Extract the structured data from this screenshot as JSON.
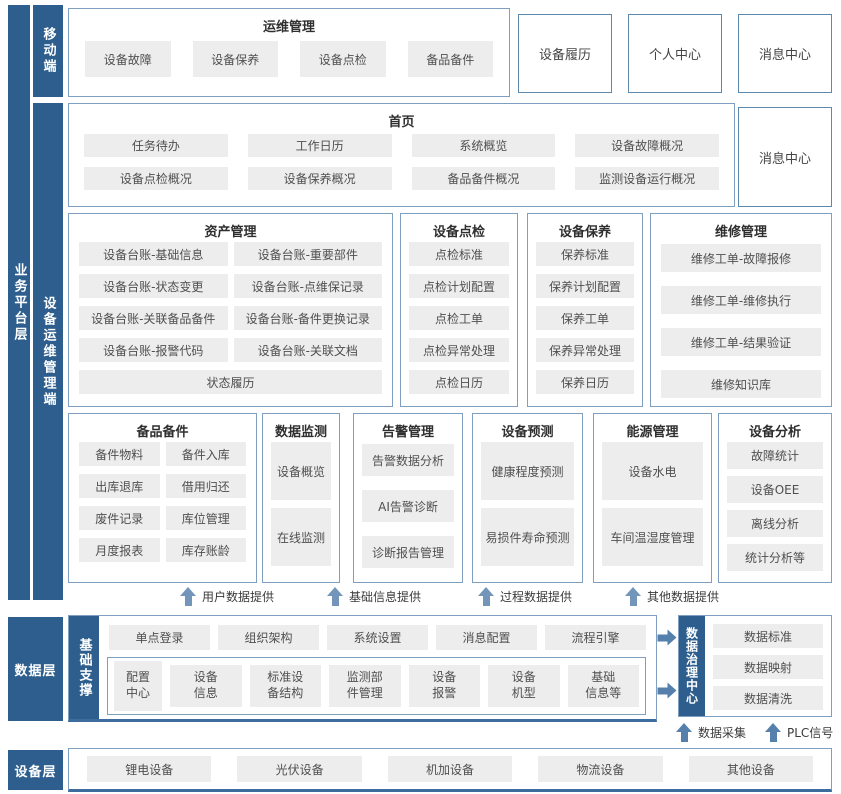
{
  "colors": {
    "dark_blue": "#2d5e8e",
    "box_border": "#7e9fbf",
    "button_bg": "#ededed",
    "arrow": "#7495ba",
    "thick_line": "#3c6d9e"
  },
  "layers": {
    "business": "业务平台层",
    "mobile": "移动端",
    "device_ops": "设备运维管理端",
    "data": "数据层",
    "base_support": "基础支撑",
    "governance": "数据治理中心",
    "device": "设备层"
  },
  "mobile_sec": {
    "title": "运维管理",
    "items": [
      "设备故障",
      "设备保养",
      "设备点检",
      "备品备件"
    ],
    "side_boxes": [
      "设备履历",
      "个人中心",
      "消息中心"
    ]
  },
  "home": {
    "title": "首页",
    "items": [
      "任务待办",
      "工作日历",
      "系统概览",
      "设备故障概况",
      "设备点检概况",
      "设备保养概况",
      "备品备件概况",
      "监测设备运行概况"
    ],
    "side_box": "消息中心"
  },
  "asset": {
    "title": "资产管理",
    "items": [
      "设备台账-基础信息",
      "设备台账-重要部件",
      "设备台账-状态变更",
      "设备台账-点维保记录",
      "设备台账-关联备品备件",
      "设备台账-备件更换记录",
      "设备台账-报警代码",
      "设备台账-关联文档"
    ],
    "full_item": "状态履历"
  },
  "inspect": {
    "title": "设备点检",
    "items": [
      "点检标准",
      "点检计划配置",
      "点检工单",
      "点检异常处理",
      "点检日历"
    ]
  },
  "maintain": {
    "title": "设备保养",
    "items": [
      "保养标准",
      "保养计划配置",
      "保养工单",
      "保养异常处理",
      "保养日历"
    ]
  },
  "repair": {
    "title": "维修管理",
    "items": [
      "维修工单-故障报修",
      "维修工单-维修执行",
      "维修工单-结果验证",
      "维修知识库"
    ]
  },
  "spares": {
    "title": "备品备件",
    "items": [
      "备件物料",
      "备件入库",
      "出库退库",
      "借用归还",
      "废件记录",
      "库位管理",
      "月度报表",
      "库存账龄"
    ]
  },
  "monitor": {
    "title": "数据监测",
    "items": [
      "设备概览",
      "在线监测"
    ]
  },
  "alarm": {
    "title": "告警管理",
    "items": [
      "告警数据分析",
      "AI告警诊断",
      "诊断报告管理"
    ]
  },
  "predict": {
    "title": "设备预测",
    "items": [
      "健康程度预测",
      "易损件寿命预测"
    ]
  },
  "energy": {
    "title": "能源管理",
    "items": [
      "设备水电",
      "车间温湿度管理"
    ]
  },
  "analysis": {
    "title": "设备分析",
    "items": [
      "故障统计",
      "设备OEE",
      "离线分析",
      "统计分析等"
    ]
  },
  "flow_up": [
    "用户数据提供",
    "基础信息提供",
    "过程数据提供",
    "其他数据提供"
  ],
  "base": {
    "row1": [
      "单点登录",
      "组织架构",
      "系统设置",
      "消息配置",
      "流程引擎"
    ],
    "row2_first": "配置\n中心",
    "row2": [
      "设备\n信息",
      "标准设\n备结构",
      "监测部\n件管理",
      "设备\n报警",
      "设备\n机型",
      "基础\n信息等"
    ]
  },
  "governance_items": [
    "数据标准",
    "数据映射",
    "数据清洗"
  ],
  "bottom_flows": [
    "数据采集",
    "PLC信号"
  ],
  "devices": [
    "锂电设备",
    "光伏设备",
    "机加设备",
    "物流设备",
    "其他设备"
  ]
}
